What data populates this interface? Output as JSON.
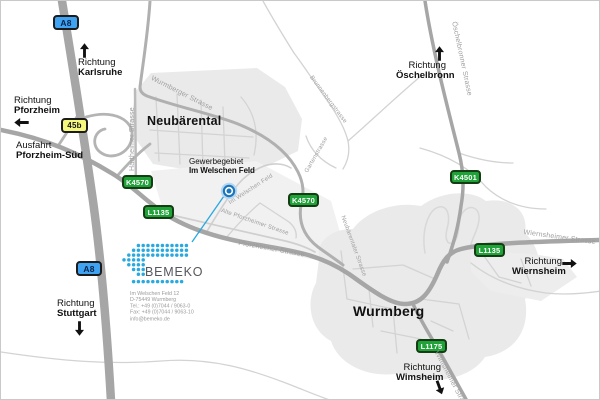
{
  "company": {
    "name": "BEMEKO",
    "brand_color": "#29a9e0",
    "address_lines": [
      "Im Welschen Feld 12",
      "D-75449 Wurmberg",
      "Tel.: +49 (0)7044 / 9063-0",
      "Fax: +49 (0)7044 / 9063-10",
      "info@bemeko.de"
    ],
    "logo_pattern": [
      "...xxxxxxxxxxx",
      "..xxxxxxxxxxxx",
      ".xxxxxxxxxxxxx",
      "xxxxx.........",
      ".xxxx.........",
      "..xxx.........",
      "...xx.........",
      "..xxxxxxxxxxx."
    ]
  },
  "poi": {
    "line1": "Gewerbegebiet",
    "line2": "Im Welschen Feld"
  },
  "towns": {
    "neubaerental": "Neubärental",
    "wurmberg": "Wurmberg"
  },
  "directions": {
    "karlsruhe": {
      "line1": "Richtung",
      "line2": "Karlsruhe"
    },
    "pforzheim": {
      "line1": "Richtung",
      "line2": "Pforzheim"
    },
    "exit_pforzheim_sued": {
      "line1": "Ausfahrt",
      "line2": "Pforzheim-Süd"
    },
    "stuttgart": {
      "line1": "Richtung",
      "line2": "Stuttgart"
    },
    "oeschelbronn": {
      "line1": "Richtung",
      "line2": "Öschelbronn"
    },
    "wiernsheim": {
      "line1": "Richtung",
      "line2": "Wiernsheim"
    },
    "wimsheim": {
      "line1": "Richtung",
      "line2": "Wimsheim"
    }
  },
  "badges": {
    "a8_north": "A8",
    "a8_south": "A8",
    "exit_45b": "45b",
    "k4570_west": "K4570",
    "k4570_mid": "K4570",
    "l1135_west": "L1135",
    "k4501": "K4501",
    "l1135_east": "L1135",
    "l1175": "L1175"
  },
  "streets": {
    "wurmberger": "Wurmberger Strasse",
    "hartheimer": "Hartheimer Strasse",
    "oeschelbronner": "Öschelbronner Strasse",
    "brunnenberg": "Brunnenbergstrasse",
    "garten": "Gartenstrasse",
    "im_welschen_feld": "Im Welschen Feld",
    "alte_pforzheimer": "Alte Pforzheimer Strasse",
    "neubaerentaler": "Neubärentaler Strasse",
    "pforzheimer": "Pforzheimer Strasse",
    "wiernsheimer": "Wiernsheimer Strasse",
    "wimsheimer": "Wimsheimer Strasse"
  },
  "colors": {
    "motorway_badge": "#3fa3f2",
    "exit_badge": "#f6f87d",
    "route_badge": "#1fa238",
    "road": "#a6a6a6",
    "town_area": "#eaeaea",
    "street_label": "#9e9e9e",
    "brand_blue": "#29a9e0",
    "marker_blue": "#1c76bc"
  }
}
